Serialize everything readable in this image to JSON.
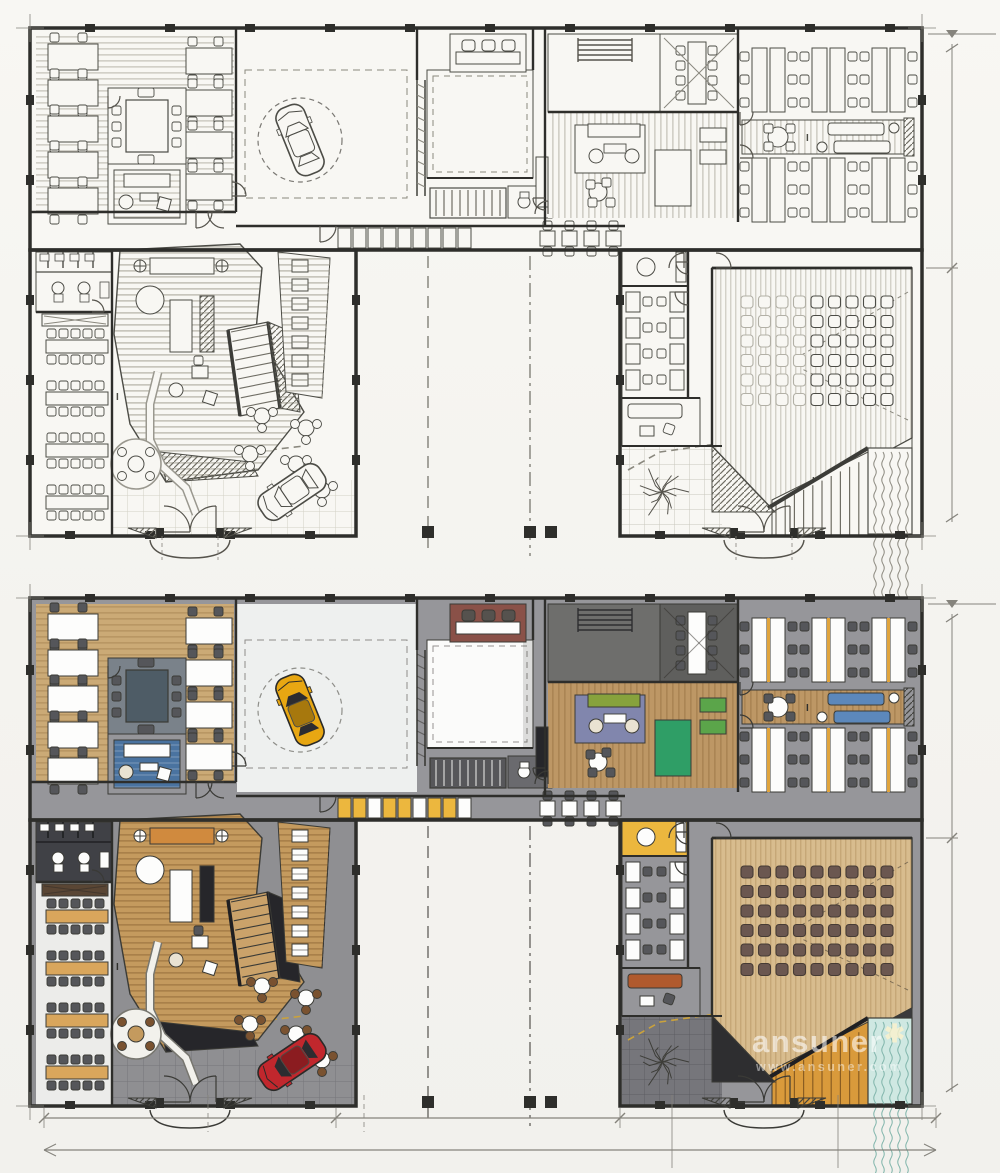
{
  "page": {
    "background": "#f5f4f1",
    "description": "Auto showroom office floor plan presented twice: hand-drawn ink sketch (top) and color marker rendering (bottom)"
  },
  "watermark": {
    "brand": "ansuner",
    "star": "✱",
    "url": "www.ansuner.com"
  },
  "section_mark": "I",
  "plans": [
    {
      "id": "sketch",
      "label": "Hand-drawn sketch floor plan",
      "style": "sketch"
    },
    {
      "id": "render",
      "label": "Color marker rendered floor plan",
      "style": "color"
    }
  ],
  "palette": {
    "paper": "#f8f7f3",
    "ink": "#4a4a46",
    "wall": "#2e2e2b",
    "dim": "#85837c",
    "corridor": "#96969a",
    "plaza": "#8f8f92",
    "tile": "#76767b",
    "tileLine": "#5d5d63",
    "woodLight": "#cbaa76",
    "woodMid": "#bd9765",
    "woodDark": "#c49a5e",
    "woodPale": "#d8bc8e",
    "white": "#fdfdfc",
    "chair": "#55565a",
    "seatBrown": "#6b5750",
    "showroom": "#eef0ef",
    "whiteRoom": "#fbfbfa",
    "restroom": "#404146",
    "darkRoom": "#6e6e6c",
    "meetRoomFloor": "#7a828a",
    "sinkRoom": "#8a5148",
    "counterDark": "#26262a",
    "rugBlue": "#4a73a0",
    "rugPurple": "#8186ad",
    "rugGreen": "#2f9e66",
    "sofaBlue": "#5c88bb",
    "sofaGreen": "#87a23c",
    "sofaOrange": "#d08a3e",
    "sofaRust": "#b05a2e",
    "cream": "#e9e2d2",
    "yellow": "#ecb73e",
    "stairOrange": "#d99a3b",
    "carYellow": "#e8a712",
    "carRed": "#c1272d",
    "carGlass": "#2c2c30",
    "water": "#cfe8e2",
    "waterLine": "#7fb4aa",
    "tree": "#3d3d38"
  },
  "counts": {
    "auditorium_rows": 6,
    "auditorium_cols": 9,
    "canteen_tables": 4,
    "canteen_chairs_per_side": 5,
    "left_office_clusters_col1": 5,
    "left_office_clusters_col2": 4,
    "right_office_rows": 2,
    "right_office_clusters_per_row": 3,
    "meeting_seats": 8,
    "locker_cells": 9,
    "corridor_tables": 4,
    "terrace_tables": 5,
    "booths": 7,
    "sinks": 3,
    "restroom_stalls": 4,
    "cafe_room_tables_per_wall": 4
  },
  "rooms": [
    {
      "id": "left-open-office",
      "label": "Open office, left wing"
    },
    {
      "id": "meeting-room",
      "label": "Meeting room"
    },
    {
      "id": "staff-lounge",
      "label": "Staff lounge"
    },
    {
      "id": "car-showroom",
      "label": "Car showroom with turntable"
    },
    {
      "id": "white-room",
      "label": "Exhibition / storage room"
    },
    {
      "id": "pantry",
      "label": "Pantry with sinks"
    },
    {
      "id": "stair-core",
      "label": "Stair core"
    },
    {
      "id": "living-lounge",
      "label": "Living lounge"
    },
    {
      "id": "small-meeting-room",
      "label": "Small meeting room"
    },
    {
      "id": "right-open-office",
      "label": "Open office, right wing"
    },
    {
      "id": "tea-lounge",
      "label": "Tea lounge strip"
    },
    {
      "id": "locker-corridor",
      "label": "Locker corridor"
    },
    {
      "id": "restrooms",
      "label": "Restrooms"
    },
    {
      "id": "canteen",
      "label": "Canteen / training tables"
    },
    {
      "id": "reception-atrium",
      "label": "Reception atrium with feature stair"
    },
    {
      "id": "booth-seating",
      "label": "Booth seating"
    },
    {
      "id": "cafe-terrace",
      "label": "Cafe terrace tables"
    },
    {
      "id": "entry-plaza",
      "label": "Entry plaza"
    },
    {
      "id": "side-cafe-room",
      "label": "Side cafe room"
    },
    {
      "id": "rest-lounge",
      "label": "Rest lounge"
    },
    {
      "id": "courtyard-garden",
      "label": "Courtyard garden with tree"
    },
    {
      "id": "auditorium",
      "label": "Auditorium"
    },
    {
      "id": "grand-steps",
      "label": "Grand steps"
    },
    {
      "id": "water-feature",
      "label": "Water feature"
    },
    {
      "id": "showroom-car",
      "label": "Showroom car on turntable"
    },
    {
      "id": "plaza-car",
      "label": "Car at entry plaza"
    }
  ]
}
